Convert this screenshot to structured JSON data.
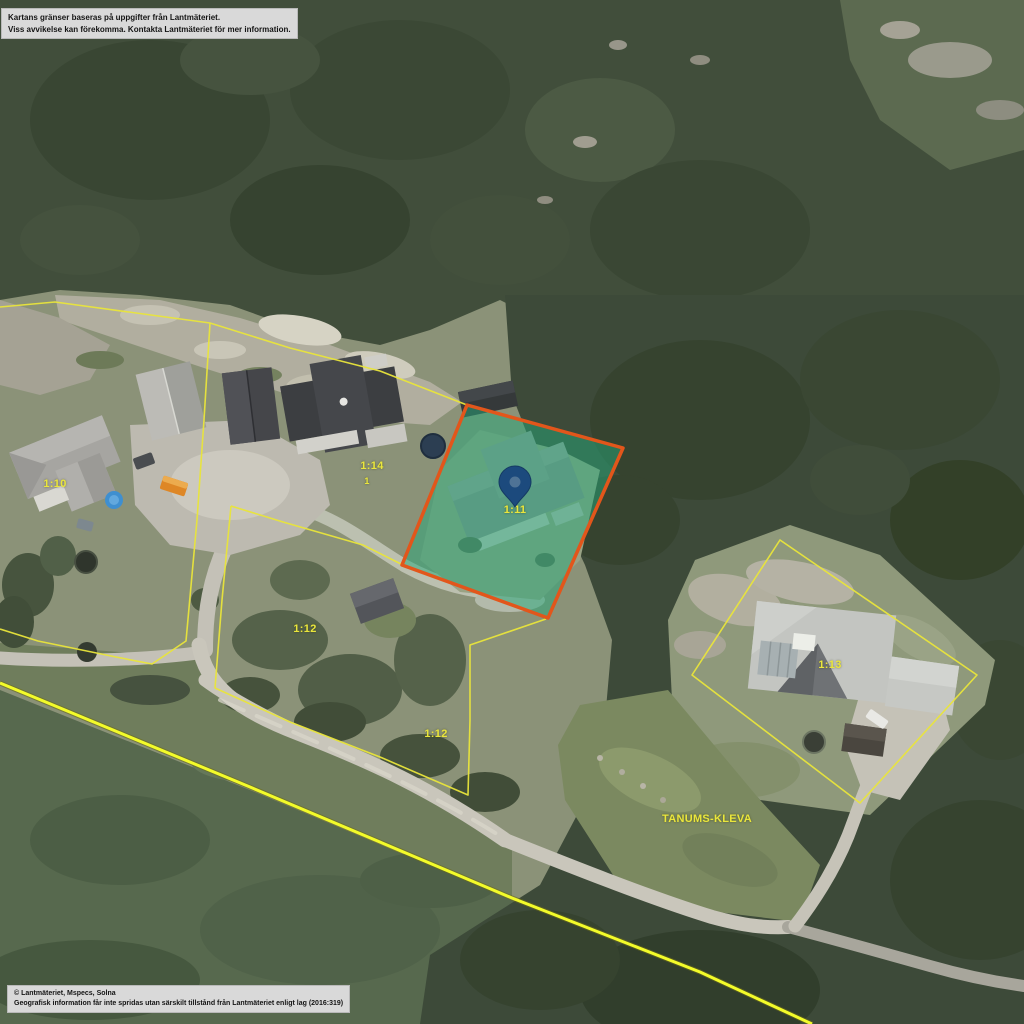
{
  "map": {
    "disclaimer": {
      "line1": "Kartans gränser baseras på uppgifter från Lantmäteriet.",
      "line2": "Viss avvikelse kan förekomma. Kontakta Lantmäteriet för mer information."
    },
    "copyright": {
      "line1": "© Lantmäteriet, Mspecs, Solna",
      "line2": "Geografisk information får inte spridas utan särskilt tillstånd från Lantmäteriet enligt lag (2016:319)"
    },
    "parcel_labels": [
      {
        "text": "1:10",
        "x": 55,
        "y": 484,
        "size": 11
      },
      {
        "text": "1:14",
        "x": 372,
        "y": 466,
        "size": 11
      },
      {
        "text": "1",
        "x": 367,
        "y": 481,
        "size": 9
      },
      {
        "text": "1:11",
        "x": 515,
        "y": 510,
        "size": 11
      },
      {
        "text": "1:12",
        "x": 305,
        "y": 629,
        "size": 11
      },
      {
        "text": "1:12",
        "x": 436,
        "y": 734,
        "size": 11
      },
      {
        "text": "1:13",
        "x": 830,
        "y": 665,
        "size": 11
      },
      {
        "text": "TANUMS-KLEVA",
        "x": 707,
        "y": 819,
        "size": 11
      }
    ],
    "selected_parcel": {
      "label": "1:11",
      "marker": "map-pin"
    },
    "colors": {
      "boundary_yellow": "#e9e53b",
      "bright_boundary_yellow": "#f3fb2a",
      "highlight_fill": "rgba(38,168,122,0.5)",
      "highlight_border": "#e2561b",
      "pin_blue": "#1c4a7d",
      "pin_inner": "#4f7396",
      "label_yellow": "#eae63c"
    }
  }
}
